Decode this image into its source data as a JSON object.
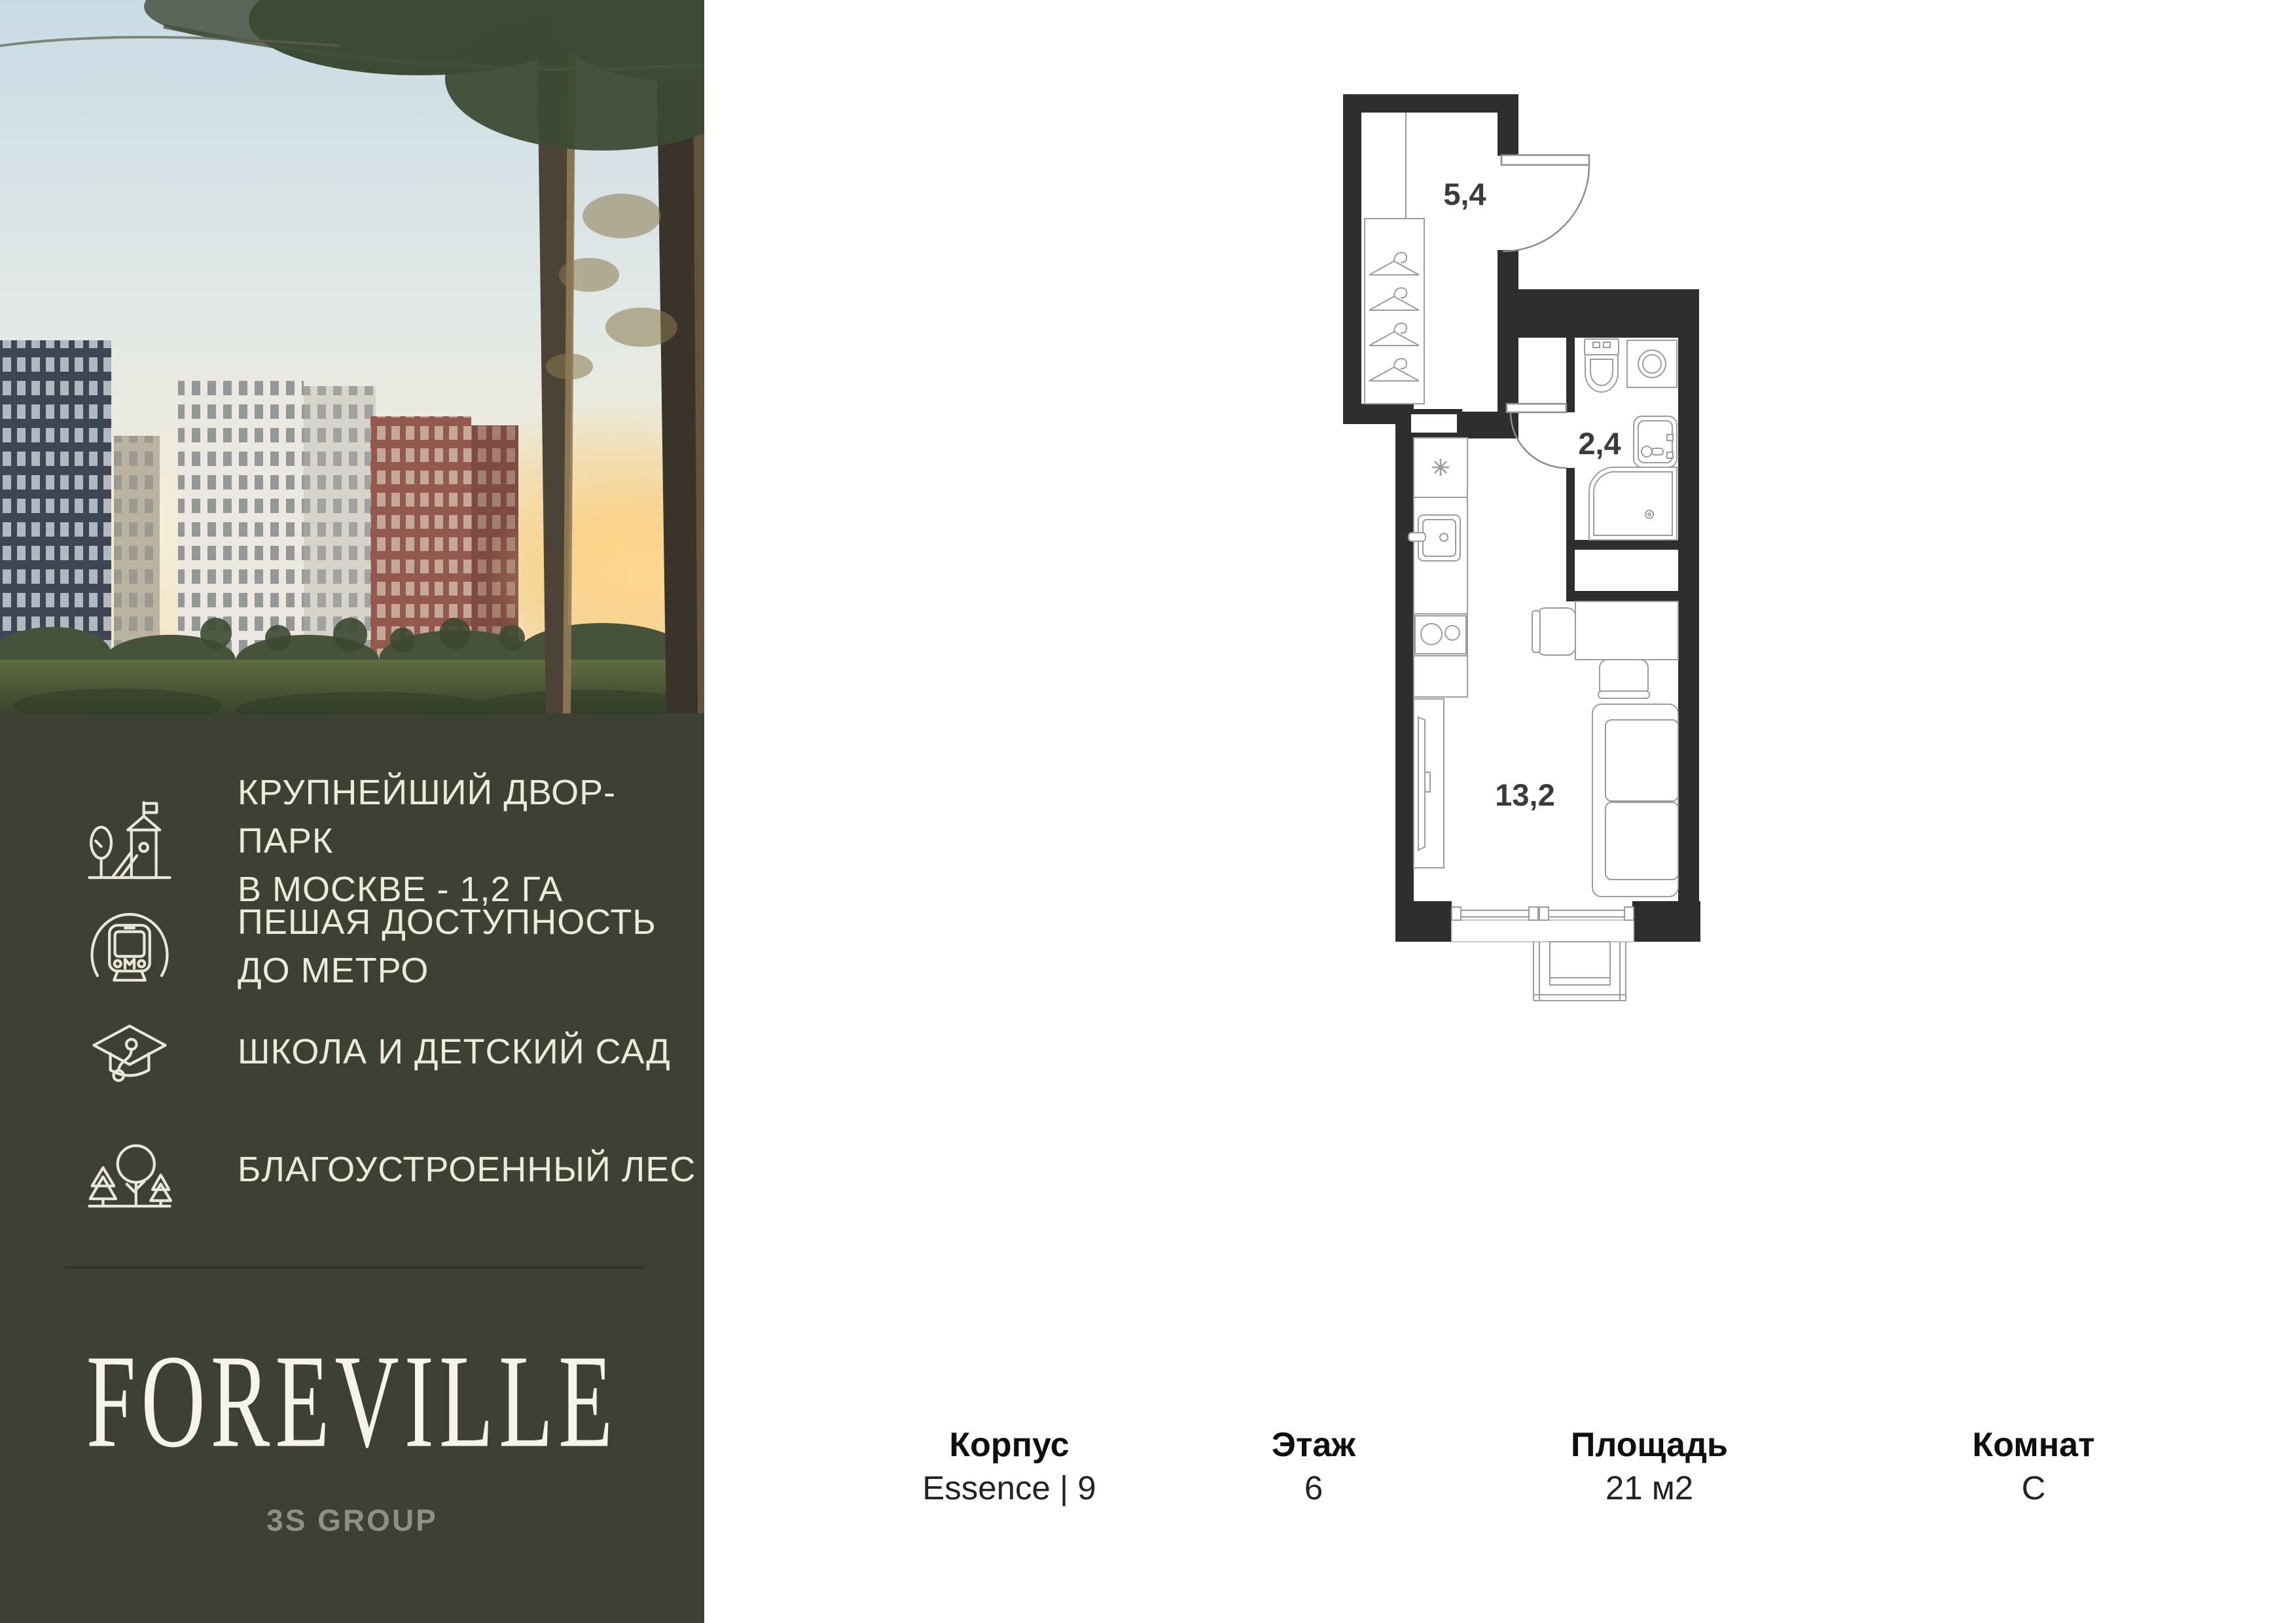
{
  "sidebar": {
    "logo": "FOREVILLE",
    "developer": "3S GROUP",
    "features": [
      {
        "icon": "playground-icon",
        "lines": [
          "КРУПНЕЙШИЙ ДВОР-ПАРК",
          "В МОСКВЕ - 1,2 ГА"
        ]
      },
      {
        "icon": "metro-icon",
        "lines": [
          "ПЕШАЯ ДОСТУПНОСТЬ",
          "ДО МЕТРО"
        ]
      },
      {
        "icon": "school-icon",
        "lines": [
          "ШКОЛА И ДЕТСКИЙ САД"
        ]
      },
      {
        "icon": "forest-icon",
        "lines": [
          "БЛАГОУСТРОЕННЫЙ ЛЕС"
        ]
      }
    ]
  },
  "floorplan": {
    "rooms": [
      {
        "name": "hallway",
        "area": "5,4"
      },
      {
        "name": "bathroom",
        "area": "2,4"
      },
      {
        "name": "living-room",
        "area": "13,2"
      }
    ]
  },
  "info": {
    "columns": [
      {
        "label": "Корпус",
        "value": "Essence | 9"
      },
      {
        "label": "Этаж",
        "value": "6"
      },
      {
        "label": "Площадь",
        "value": "21 м2"
      },
      {
        "label": "Комнат",
        "value": "С"
      }
    ]
  },
  "colors": {
    "sidebar_bg": "#3d4134",
    "icon_stroke": "#eae7da",
    "sidebar_text": "#eceadb",
    "logo_text": "#f6f4ea",
    "developer_text": "#8e9083",
    "plan_wall": "#2e2e2e",
    "plan_furniture_line": "#9c9c9c",
    "plan_label": "#3b3b3b"
  }
}
